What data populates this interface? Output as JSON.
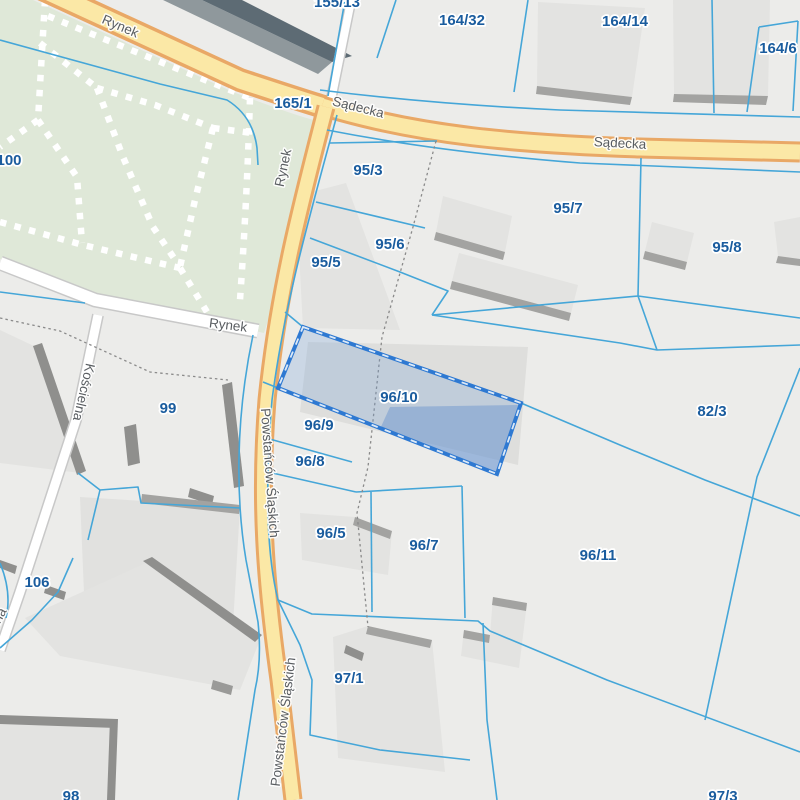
{
  "app": {
    "name": "Cadastral parcel map",
    "selected_parcel": "96/10"
  },
  "colors": {
    "background": "#ececea",
    "park_green": "#dfe8d8",
    "road_fill": "#fbe8a6",
    "road_casing": "#e9a866",
    "minor_road_fill": "#ffffff",
    "minor_road_casing": "#c8c8c8",
    "parcel_line": "#45a6d8",
    "parcel_label": "#1a5c9e",
    "street_label": "#595d61",
    "selection_border": "#2e79d2",
    "selection_fill": "rgba(120,160,215,0.28)",
    "selection_building_fill": "rgba(95,140,205,0.42)",
    "building_fill": "#e3e3e1",
    "building_shadow": "#8f8f8d"
  },
  "parcel_labels": [
    {
      "text": "155/13",
      "x": 337,
      "y": 3
    },
    {
      "text": "164/32",
      "x": 462,
      "y": 21
    },
    {
      "text": "164/14",
      "x": 625,
      "y": 22
    },
    {
      "text": "164/6",
      "x": 778,
      "y": 49
    },
    {
      "text": "165/1",
      "x": 293,
      "y": 104
    },
    {
      "text": "100",
      "x": 9,
      "y": 161
    },
    {
      "text": "95/3",
      "x": 368,
      "y": 171
    },
    {
      "text": "95/7",
      "x": 568,
      "y": 209
    },
    {
      "text": "95/6",
      "x": 390,
      "y": 245
    },
    {
      "text": "95/8",
      "x": 727,
      "y": 248
    },
    {
      "text": "95/5",
      "x": 326,
      "y": 263
    },
    {
      "text": "96/10",
      "x": 399,
      "y": 398
    },
    {
      "text": "82/3",
      "x": 712,
      "y": 412
    },
    {
      "text": "99",
      "x": 168,
      "y": 409
    },
    {
      "text": "96/9",
      "x": 319,
      "y": 426
    },
    {
      "text": "96/8",
      "x": 310,
      "y": 462
    },
    {
      "text": "96/5",
      "x": 331,
      "y": 534
    },
    {
      "text": "96/7",
      "x": 424,
      "y": 546
    },
    {
      "text": "96/11",
      "x": 598,
      "y": 556
    },
    {
      "text": "106",
      "x": 37,
      "y": 583
    },
    {
      "text": "97/1",
      "x": 349,
      "y": 679
    },
    {
      "text": "98",
      "x": 71,
      "y": 797
    },
    {
      "text": "97/3",
      "x": 723,
      "y": 797
    }
  ],
  "street_labels": [
    {
      "text": "Rynek",
      "x": 120,
      "y": 27,
      "rot": 23
    },
    {
      "text": "Sądecka",
      "x": 358,
      "y": 108,
      "rot": 14
    },
    {
      "text": "Sądecka",
      "x": 620,
      "y": 144,
      "rot": 3
    },
    {
      "text": "Rynek",
      "x": 284,
      "y": 168,
      "rot": -78
    },
    {
      "text": "Rynek",
      "x": 228,
      "y": 326,
      "rot": 7
    },
    {
      "text": "Kościelna",
      "x": 83,
      "y": 392,
      "rot": 103
    },
    {
      "text": "Powstańców Śląskich",
      "x": 269,
      "y": 473,
      "rot": 86
    },
    {
      "text": "Powstańców Śląskich",
      "x": 284,
      "y": 722,
      "rot": -83
    },
    {
      "text": "Kościelna",
      "x": -10,
      "y": 635,
      "rot": -62
    }
  ]
}
